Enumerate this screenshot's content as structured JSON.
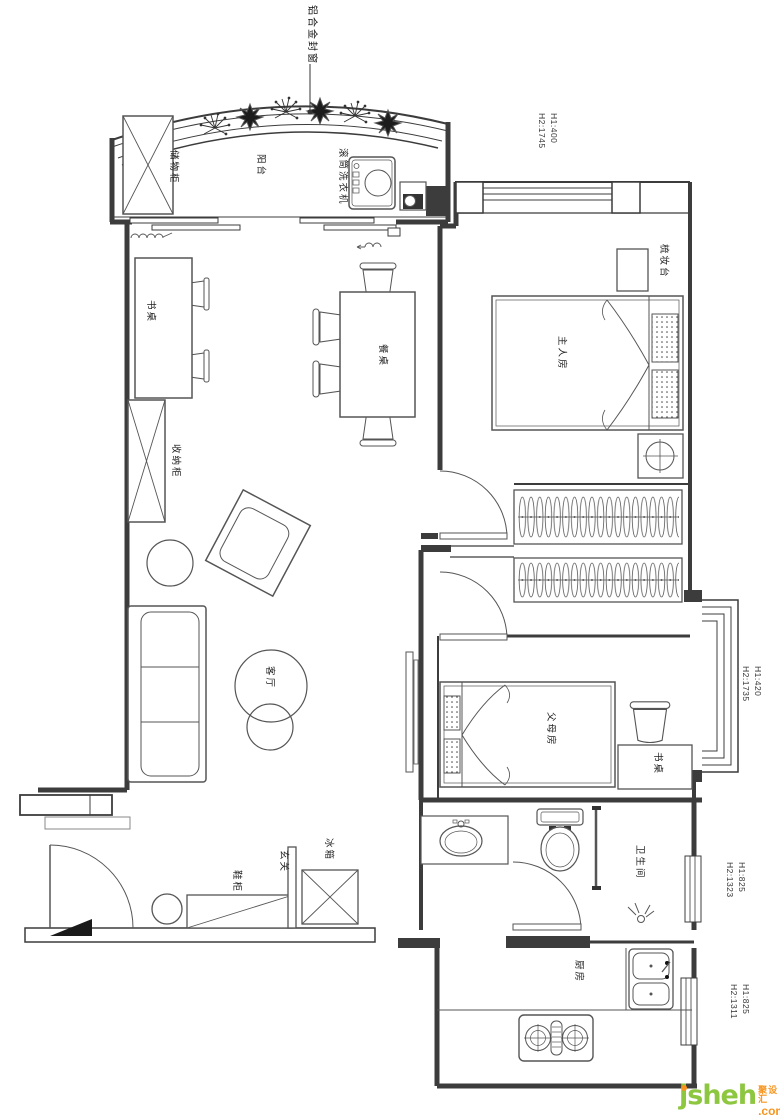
{
  "plan": {
    "callout_label": "铝合金封窗",
    "rooms": {
      "balcony": "阳台",
      "living": "客厅",
      "master": "主人房",
      "parents": "父母房",
      "bathroom": "卫生间",
      "kitchen": "厨房",
      "entrance": "玄关"
    },
    "furniture": {
      "storage_cabinet": "储物柜",
      "washing_machine": "滚筒洗衣机",
      "desk_study": "书桌",
      "dining_table": "餐桌",
      "organizer_cabinet": "收纳柜",
      "dresser": "梳妆台",
      "desk_parents": "书桌",
      "shoe_cabinet": "鞋柜",
      "fridge": "冰箱"
    },
    "dimensions": {
      "d1": [
        "H1:400",
        "H2:1745"
      ],
      "d2": [
        "H1:420",
        "H2:1735"
      ],
      "d3": [
        "H1:825",
        "H2:1323"
      ],
      "d4": [
        "H1:825",
        "H2:1311"
      ]
    }
  },
  "logo": {
    "latin": "jsheh",
    "cn": "聚设汇",
    "tld": ".com"
  },
  "colors": {
    "line": "#3c3c3c",
    "logo_green": "#8dc63f",
    "logo_orange": "#f7941d"
  }
}
